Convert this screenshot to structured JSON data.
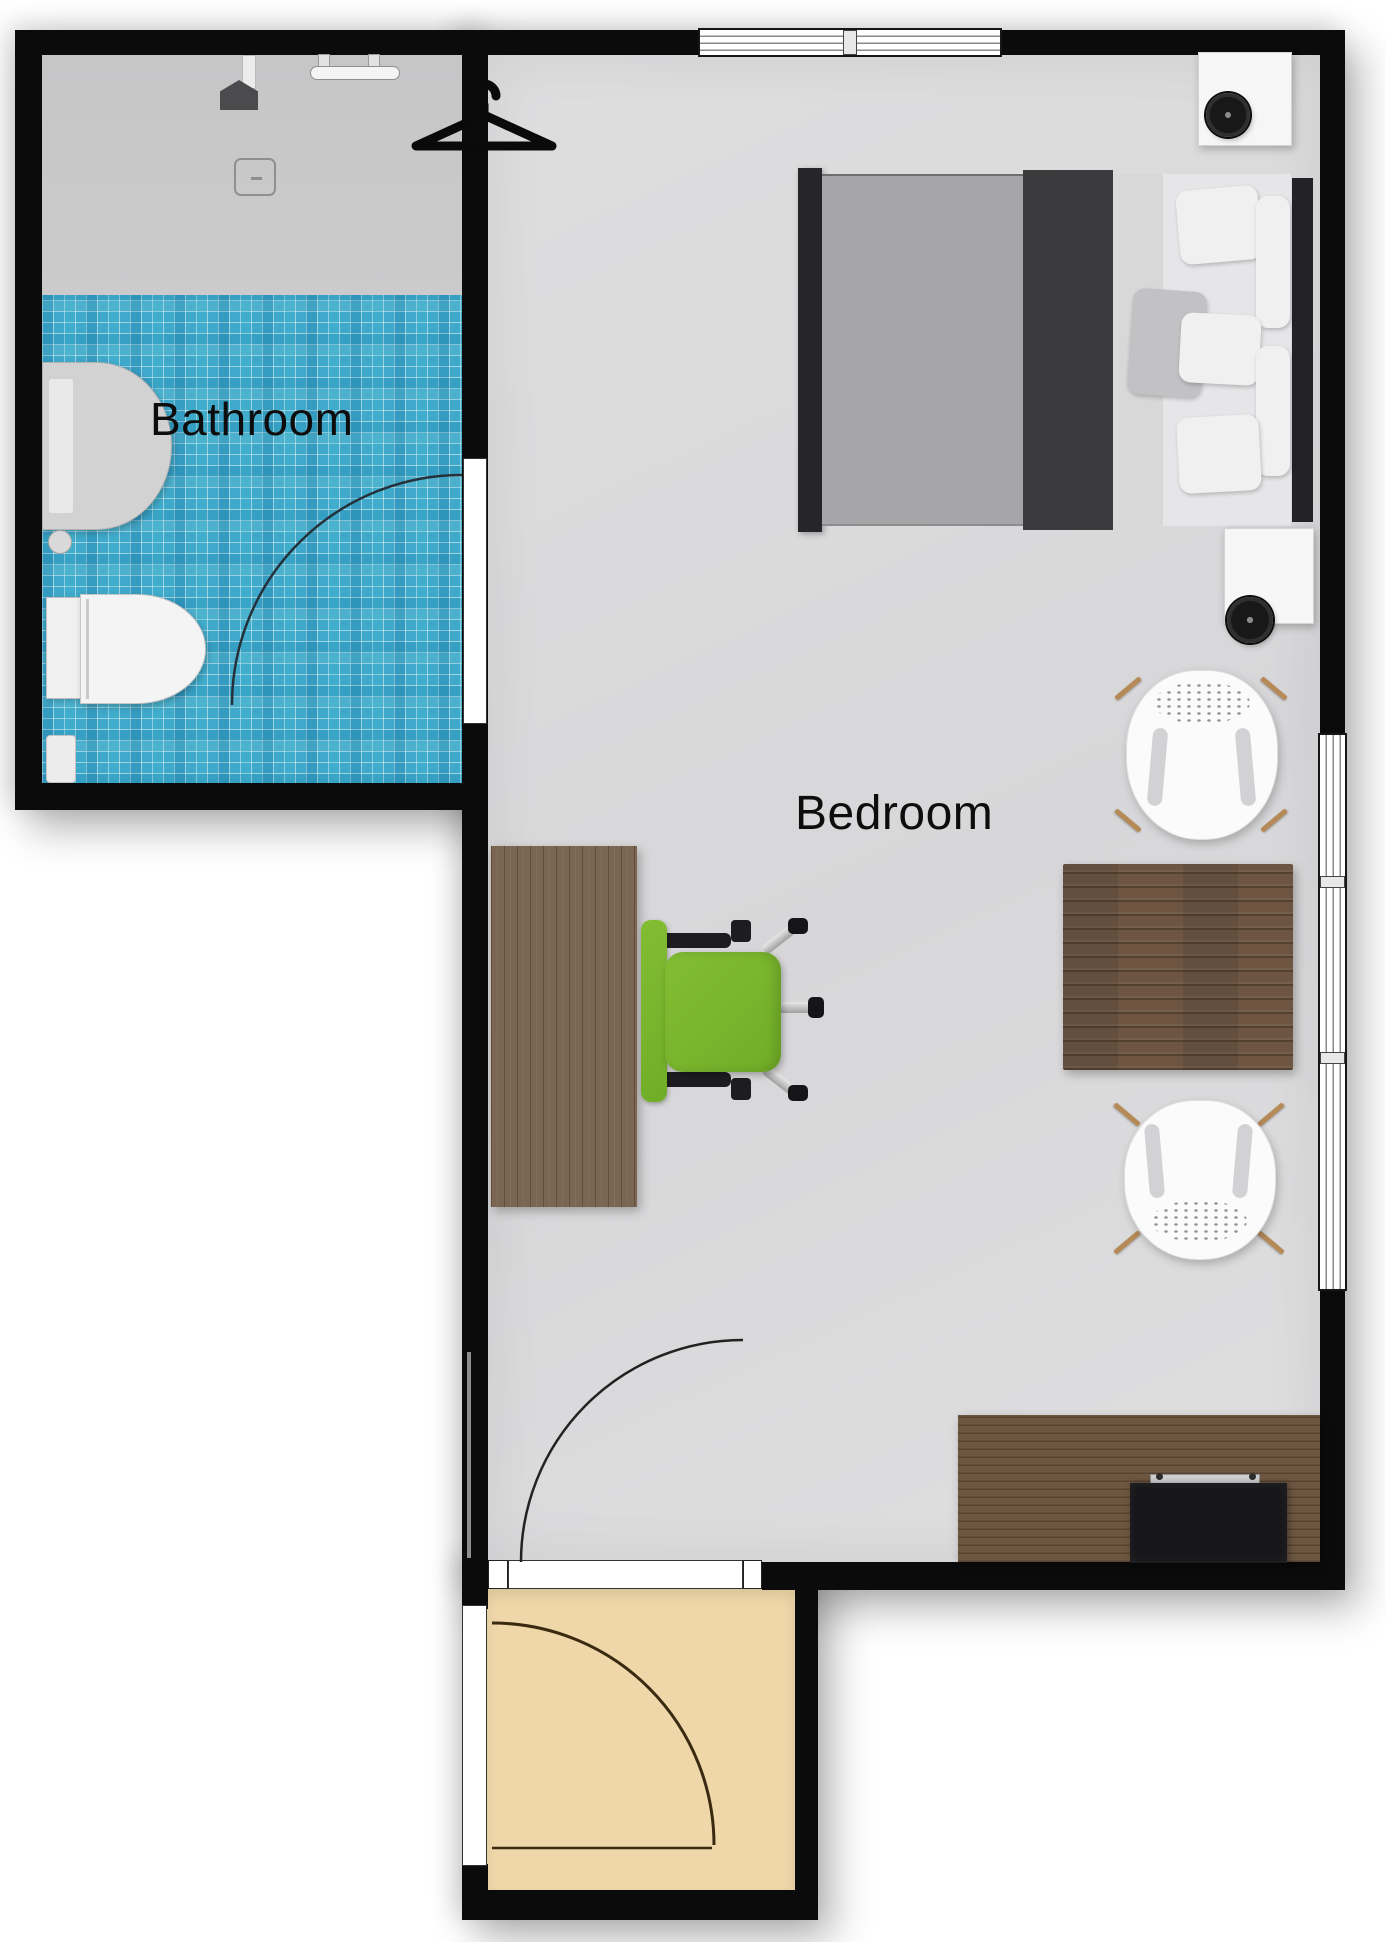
{
  "title": "Studio apartment floor plan",
  "rooms": {
    "bathroom": {
      "label": "Bathroom"
    },
    "bedroom": {
      "label": "Bedroom"
    }
  },
  "colors": {
    "wall": "#0b0b0c",
    "bathroom_tile": "#3fa9cb",
    "shower_floor": "#c9c9ca",
    "bedroom_floor": "#dadadc",
    "entry_floor": "#efd7a9",
    "wood_dark": "#6d5542",
    "wood_desk": "#7b6553",
    "office_chair_green": "#7cb82f",
    "bed_duvet": "#3b3b3e",
    "outside": "#ffffff"
  },
  "icons": [
    "clothes-hanger-icon",
    "shower-head-icon",
    "floor-drain-icon",
    "door-swing-arc"
  ],
  "furniture": [
    "double-bed",
    "pillows",
    "headboard",
    "nightstand",
    "round-speaker",
    "shell-side-chair",
    "dining-table",
    "desk",
    "office-chair",
    "tv-dresser",
    "tv",
    "soundbar",
    "toilet",
    "wall-sink",
    "towel-rail",
    "waste-bin"
  ],
  "openings": [
    "top-wall-window",
    "right-wall-window",
    "bathroom-door",
    "bedroom-entry-door",
    "front-door",
    "entry-sidelight"
  ]
}
